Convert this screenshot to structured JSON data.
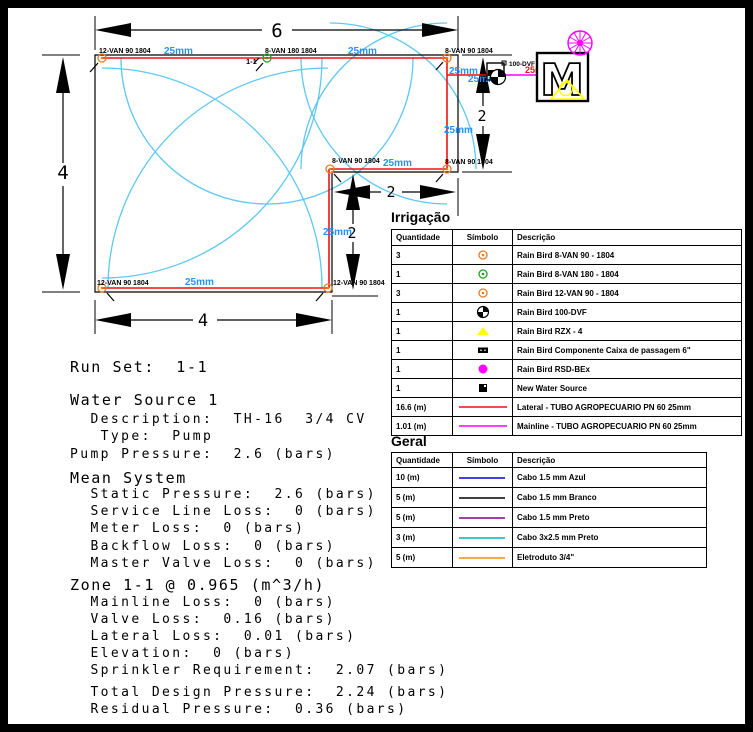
{
  "colors": {
    "lateral_pipe": "#ee1111",
    "mainline_pipe": "#ff00ff",
    "coverage_arc": "#5ec8f2",
    "pipe_size_label": "#2492ff",
    "mainline_size_label": "#ee1111",
    "nozzle_orange": "#ef7b1f",
    "nozzle_green": "#22a022",
    "rzx_yellow": "#ffff00",
    "rsd_magenta": "#ff00ff",
    "cable_blue": "#0000ee",
    "cable_black": "#000000",
    "cable_purple": "#800080",
    "cable_cyan": "#00b5b5",
    "eletroduto_orange": "#ff8c00"
  },
  "plan": {
    "dims": {
      "width_top": "6",
      "height_left": "4",
      "width_bottom": "4",
      "height_right": "2",
      "notch_width": "2",
      "notch_height": "2"
    },
    "zone_callout": "1-1",
    "valve_label": "100-DVF",
    "meter_letter": "M",
    "mainline_size_label": "25mm",
    "sprinkler_labels": [
      "12-VAN 90 1804",
      "8-VAN 180 1804",
      "8-VAN 90 1804",
      "8-VAN 90 1804",
      "8-VAN 90 1804",
      "12-VAN 90 1804",
      "12-VAN 90 1804"
    ],
    "pipe_size_labels": [
      "25mm",
      "25mm",
      "25mm",
      "25mm",
      "25mm",
      "25mm",
      "25mm",
      "25mm"
    ]
  },
  "report": {
    "lines": [
      "Run Set:  1-1",
      "Water Source 1",
      "  Description:  TH-16  3/4 CV",
      "   Type:  Pump",
      "Pump Pressure:  2.6 (bars)",
      "Mean System",
      "  Static Pressure:  2.6 (bars)",
      "  Service Line Loss:  0 (bars)",
      "  Meter Loss:  0 (bars)",
      "  Backflow Loss:  0 (bars)",
      "  Master Valve Loss:  0 (bars)",
      "Zone 1-1 @ 0.965 (m^3/h)",
      "  Mainline Loss:  0 (bars)",
      "  Valve Loss:  0.16 (bars)",
      "  Lateral Loss:  0.01 (bars)",
      "  Elevation:  0 (bars)",
      "  Sprinkler Requirement:  2.07 (bars)",
      "  Total Design Pressure:  2.24 (bars)",
      "  Residual Pressure:  0.36 (bars)"
    ]
  },
  "tables": {
    "irrigacao": {
      "title": "Irrigação",
      "headers": [
        "Quantidade",
        "Símbolo",
        "Descrição"
      ],
      "rows": [
        {
          "qty": "3",
          "symbol": "nozzle-orange",
          "desc": "Rain Bird 8-VAN 90 - 1804"
        },
        {
          "qty": "1",
          "symbol": "nozzle-green",
          "desc": "Rain Bird 8-VAN 180 - 1804"
        },
        {
          "qty": "3",
          "symbol": "nozzle-orange",
          "desc": "Rain Bird 12-VAN 90 - 1804"
        },
        {
          "qty": "1",
          "symbol": "valve-dvf",
          "desc": "Rain Bird 100-DVF"
        },
        {
          "qty": "1",
          "symbol": "controller-triangle",
          "desc": "Rain Bird RZX - 4"
        },
        {
          "qty": "1",
          "symbol": "pass-box",
          "desc": "Rain Bird Componente Caixa de passagem 6\""
        },
        {
          "qty": "1",
          "symbol": "rain-sensor",
          "desc": "Rain Bird RSD-BEx"
        },
        {
          "qty": "1",
          "symbol": "water-source",
          "desc": "New Water Source"
        },
        {
          "qty": "16.6 (m)",
          "symbol": "line-red",
          "desc": "Lateral - TUBO AGROPECUARIO PN 60 25mm"
        },
        {
          "qty": "1.01 (m)",
          "symbol": "line-magenta",
          "desc": "Mainline - TUBO AGROPECUARIO PN 60 25mm"
        }
      ]
    },
    "geral": {
      "title": "Geral",
      "headers": [
        "Quantidade",
        "Símbolo",
        "Descrição"
      ],
      "rows": [
        {
          "qty": "10 (m)",
          "symbol": "line-blue",
          "desc": "Cabo 1.5 mm Azul"
        },
        {
          "qty": "5 (m)",
          "symbol": "line-black",
          "desc": "Cabo 1.5 mm Branco"
        },
        {
          "qty": "5 (m)",
          "symbol": "line-purple",
          "desc": "Cabo 1.5 mm Preto"
        },
        {
          "qty": "3 (m)",
          "symbol": "line-cyan",
          "desc": "Cabo 3x2.5 mm Preto"
        },
        {
          "qty": "5 (m)",
          "symbol": "line-orange",
          "desc": "Eletroduto 3/4\""
        }
      ]
    }
  }
}
